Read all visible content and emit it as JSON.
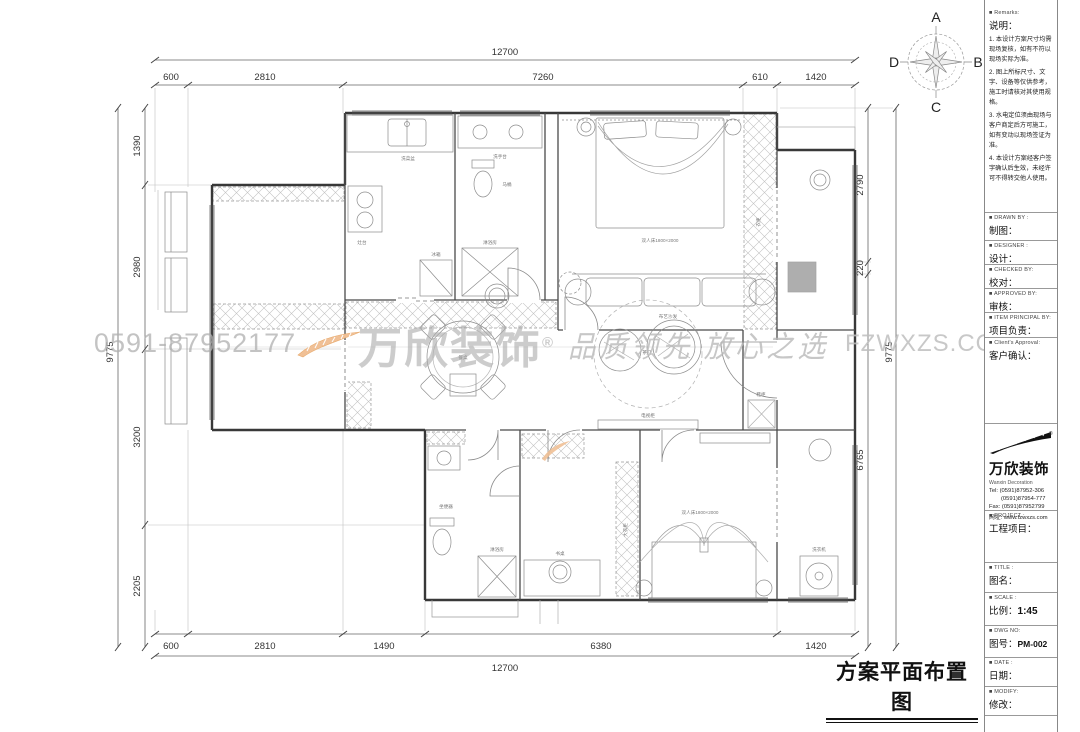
{
  "drawing_title": "方案平面布置图",
  "compass": {
    "n": "A",
    "e": "B",
    "s": "C",
    "w": "D"
  },
  "watermark": {
    "phone": "0591-87952177",
    "brand": "万欣装饰",
    "reg": "®",
    "slogan": "品质领先 放心之选",
    "site": "FZWXZS.COM"
  },
  "dims": {
    "top": {
      "overall": "12700",
      "segments": [
        "600",
        "2810",
        "7260",
        "610",
        "1420"
      ]
    },
    "bottom": {
      "overall": "12700",
      "segments": [
        "600",
        "2810",
        "1490",
        "6380",
        "1420"
      ]
    },
    "left": {
      "overall": "9775",
      "segments": [
        "1390",
        "2980",
        "3200",
        "2205"
      ]
    },
    "right": {
      "overall": "9775",
      "segments": [
        "2790",
        "220",
        "6765"
      ]
    }
  },
  "plan_labels": [
    "洗菜盆",
    "灶台",
    "冰箱",
    "洗手台",
    "马桶",
    "淋浴房",
    "双人床1800×2000",
    "衣柜",
    "布艺沙发",
    "茶几",
    "餐桌",
    "鞋柜",
    "双人床1800×2000",
    "大衣柜",
    "书桌",
    "坐便器",
    "淋浴房",
    "洗衣机",
    "电视柜"
  ],
  "titleblock": {
    "remarks_en": "■ Remarks:",
    "remarks_cn": "说明：",
    "notes": [
      "1. 本设计方案尺寸均需现场复核，如有不符以现场实际为准。",
      "2. 图上所标尺寸、文字、设备等仅供参考，施工时请核对其使用规格。",
      "3. 水电定位须由现场与客户商定后方可施工，如有变动以现场签证为准。",
      "4. 本设计方案经客户签字确认后生效，未经许可不得转交他人使用。"
    ],
    "fields": [
      {
        "en": "■ DRAWN  BY :",
        "cn": "制图："
      },
      {
        "en": "■ DESIGNER :",
        "cn": "设计："
      },
      {
        "en": "■ CHECKED  BY:",
        "cn": "校对："
      },
      {
        "en": "■ APPROVED  BY:",
        "cn": "审核："
      },
      {
        "en": "■ ITEM PRINCIPAL BY:",
        "cn": "项目负责："
      },
      {
        "en": "■ Client's Approval:",
        "cn": "客户确认："
      }
    ],
    "company": {
      "name": "万欣装饰",
      "en": "Wanxin Decoration",
      "tel1": "Tel: (0591)87952-306",
      "tel2": "(0591)87954-777",
      "fax": "Fax: (0591)87952799",
      "web": "网址: www.fzwxzs.com"
    },
    "project": {
      "en": "■ PROJECT :",
      "cn": "工程项目："
    },
    "title": {
      "en": "■ TITLE :",
      "cn": "图名："
    },
    "scale": {
      "en": "■ SCALE :",
      "cn": "比例：",
      "value": "1:45"
    },
    "dwg": {
      "en": "■ DWG  NO:",
      "cn": "图号：",
      "value": "PM-002"
    },
    "date": {
      "en": "■ DATE :",
      "cn": "日期："
    },
    "modify": {
      "en": "■ MODIFY:",
      "cn": "修改："
    }
  }
}
